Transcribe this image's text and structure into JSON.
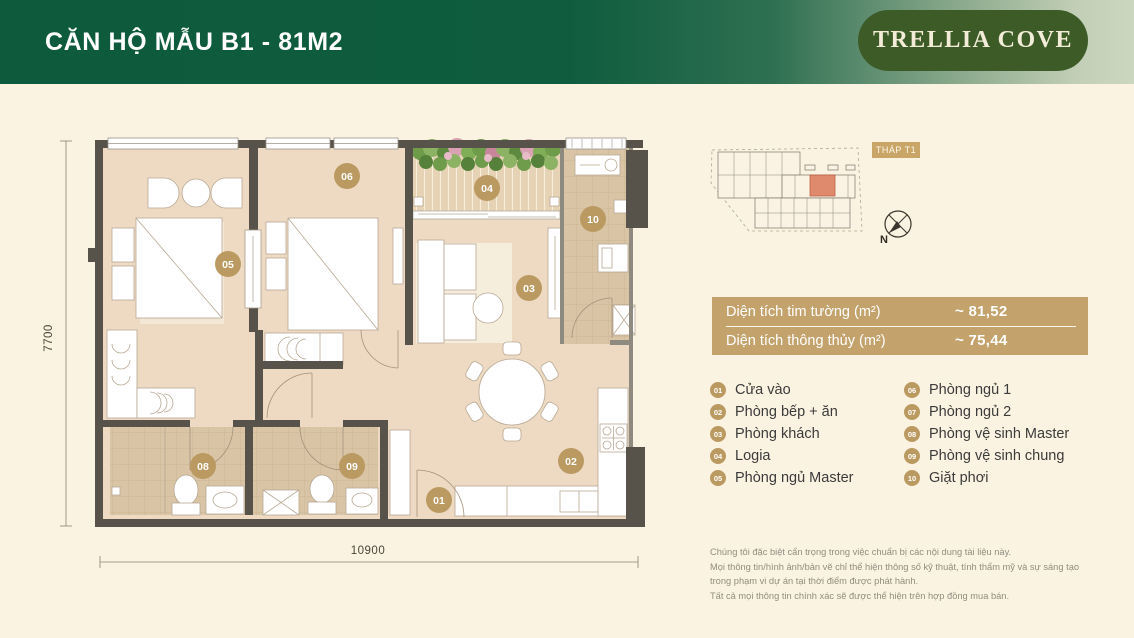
{
  "header": {
    "title": "CĂN HỘ MẪU B1 - 81M2",
    "brand": "TRELLIA COVE"
  },
  "key_plan": {
    "tower_label": "THÁP T1",
    "compass_label": "N"
  },
  "plan": {
    "dim_width": "10900",
    "dim_height": "7700",
    "markers": {
      "m01": "01",
      "m02": "02",
      "m03": "03",
      "m04": "04",
      "m05": "05",
      "m06": "06",
      "m08": "08",
      "m09": "09",
      "m10": "10"
    }
  },
  "area_table": {
    "rows": [
      {
        "label": "Diện tích tim tường (m²)",
        "value": "~ 81,52"
      },
      {
        "label": "Diện tích thông thủy (m²)",
        "value": "~ 75,44"
      }
    ]
  },
  "legend": {
    "left": [
      {
        "num": "01",
        "label": "Cửa vào"
      },
      {
        "num": "02",
        "label": "Phòng bếp + ăn"
      },
      {
        "num": "03",
        "label": "Phòng khách"
      },
      {
        "num": "04",
        "label": "Logia"
      },
      {
        "num": "05",
        "label": "Phòng ngủ Master"
      }
    ],
    "right": [
      {
        "num": "06",
        "label": "Phòng ngủ 1"
      },
      {
        "num": "07",
        "label": "Phòng ngủ 2"
      },
      {
        "num": "08",
        "label": "Phòng vệ sinh Master"
      },
      {
        "num": "09",
        "label": "Phòng vệ sinh chung"
      },
      {
        "num": "10",
        "label": "Giặt phơi"
      }
    ]
  },
  "disclaimer": {
    "lines": [
      "Chúng tôi đặc biệt cẩn trọng trong việc chuẩn bị các nội dung tài liệu này.",
      "Mọi thông tin/hình ảnh/bản vẽ chỉ thể hiện thông số kỹ thuật, tính thẩm mỹ và sự sáng tạo",
      "trong phạm vi dự án tại thời điểm được phát hành.",
      "Tất cả mọi thông tin chính xác sẽ được thể hiện trên hợp đồng mua bán."
    ]
  },
  "colors": {
    "header_green": "#0d5a3c",
    "badge_green": "#3c5b26",
    "gold": "#bb9a62",
    "table_gold": "#c3a26c",
    "page_bg": "#fbf3e1",
    "floor": "#eedac3",
    "wall": "#57524a",
    "unit_highlight": "#df8a6c"
  }
}
